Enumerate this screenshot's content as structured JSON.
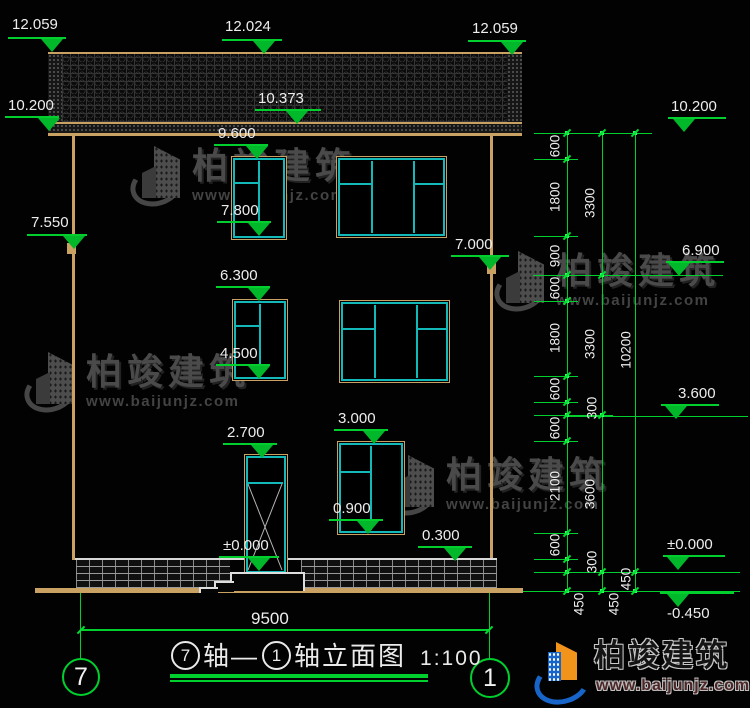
{
  "drawing": {
    "title": "⑦轴—①轴立面图 1:100",
    "title_block": {
      "axis_a": "7",
      "seg_a": "轴—",
      "axis_b": "1",
      "seg_b": "轴立面图",
      "scale": "1:100"
    },
    "axis_bubbles": {
      "left": "7",
      "right": "1"
    },
    "width_dim": "9500",
    "brand": {
      "name": "柏竣建筑",
      "url": "www.baijunjz.com"
    },
    "colors": {
      "line_green": "#00cf2e",
      "frame_tan": "#c9a263",
      "window_cyan": "#13b8b8",
      "text_white": "#ededed",
      "logo_blue": "#1765c8",
      "logo_orange": "#f2931c"
    },
    "elevation_markers": [
      {
        "label": "12.059",
        "tx": 12,
        "ty": 17,
        "bx": 8,
        "by": 37,
        "bw": 58,
        "ax": 52
      },
      {
        "label": "12.024",
        "tx": 225,
        "ty": 19,
        "bx": 222,
        "by": 39,
        "bw": 60,
        "ax": 264
      },
      {
        "label": "12.059",
        "tx": 472,
        "ty": 21,
        "bx": 468,
        "by": 40,
        "bw": 58,
        "ax": 512
      },
      {
        "label": "10.200",
        "tx": 8,
        "ty": 98,
        "bx": 5,
        "by": 116,
        "bw": 54,
        "ax": 49
      },
      {
        "label": "10.373",
        "tx": 258,
        "ty": 91,
        "bx": 255,
        "by": 109,
        "bw": 66,
        "ax": 297
      },
      {
        "label": "10.200",
        "tx": 671,
        "ty": 99,
        "bx": 668,
        "by": 117,
        "bw": 58,
        "ax": 684
      },
      {
        "label": "9.600",
        "tx": 218,
        "ty": 126,
        "bx": 214,
        "by": 144,
        "bw": 54,
        "ax": 257
      },
      {
        "label": "7.800",
        "tx": 221,
        "ty": 203,
        "bx": 217,
        "by": 221,
        "bw": 54,
        "ax": 259
      },
      {
        "label": "7.550",
        "tx": 31,
        "ty": 215,
        "bx": 27,
        "by": 234,
        "bw": 60,
        "ax": 74
      },
      {
        "label": "7.000",
        "tx": 455,
        "ty": 237,
        "bx": 451,
        "by": 255,
        "bw": 58,
        "ax": 490
      },
      {
        "label": "6.900",
        "tx": 682,
        "ty": 243,
        "bx": 666,
        "by": 261,
        "bw": 58,
        "ax": 679
      },
      {
        "label": "6.300",
        "tx": 220,
        "ty": 268,
        "bx": 216,
        "by": 286,
        "bw": 54,
        "ax": 259
      },
      {
        "label": "4.500",
        "tx": 220,
        "ty": 346,
        "bx": 216,
        "by": 364,
        "bw": 54,
        "ax": 259
      },
      {
        "label": "3.600",
        "tx": 678,
        "ty": 386,
        "bx": 661,
        "by": 404,
        "bw": 58,
        "ax": 676
      },
      {
        "label": "3.000",
        "tx": 338,
        "ty": 411,
        "bx": 334,
        "by": 429,
        "bw": 54,
        "ax": 374
      },
      {
        "label": "2.700",
        "tx": 227,
        "ty": 425,
        "bx": 223,
        "by": 443,
        "bw": 54,
        "ax": 262
      },
      {
        "label": "0.900",
        "tx": 333,
        "ty": 501,
        "bx": 329,
        "by": 519,
        "bw": 54,
        "ax": 368
      },
      {
        "label": "0.300",
        "tx": 422,
        "ty": 528,
        "bx": 418,
        "by": 546,
        "bw": 54,
        "ax": 455
      },
      {
        "label": "±0.000",
        "tx": 223,
        "ty": 538,
        "bx": 219,
        "by": 556,
        "bw": 60,
        "ax": 259
      },
      {
        "label": "±0.000",
        "tx": 667,
        "ty": 537,
        "bx": 663,
        "by": 555,
        "bw": 62,
        "ax": 678
      },
      {
        "label": "-0.450",
        "tx": 667,
        "ty": 606,
        "bx": 660,
        "by": 592,
        "bw": 74,
        "ax": 678
      }
    ],
    "dim_chains": {
      "lines": [
        {
          "x": 567,
          "y1": 133,
          "y2": 591
        },
        {
          "x": 602,
          "y1": 133,
          "y2": 591
        },
        {
          "x": 635,
          "y1": 133,
          "y2": 591
        }
      ],
      "ticks": [
        {
          "x": 567,
          "ys": [
            133,
            159,
            236,
            275,
            301,
            376,
            402,
            415,
            441,
            533,
            559,
            572,
            591
          ]
        },
        {
          "x": 602,
          "ys": [
            133,
            275,
            415,
            572,
            591
          ]
        },
        {
          "x": 635,
          "ys": [
            133,
            572,
            591
          ]
        }
      ]
    },
    "dimensions": [
      {
        "v": "600",
        "x": 555,
        "y": 146
      },
      {
        "v": "1800",
        "x": 555,
        "y": 197
      },
      {
        "v": "900",
        "x": 555,
        "y": 256
      },
      {
        "v": "600",
        "x": 555,
        "y": 288
      },
      {
        "v": "1800",
        "x": 555,
        "y": 338
      },
      {
        "v": "600",
        "x": 555,
        "y": 389
      },
      {
        "v": "300",
        "x": 592,
        "y": 408
      },
      {
        "v": "600",
        "x": 555,
        "y": 428
      },
      {
        "v": "2100",
        "x": 555,
        "y": 486
      },
      {
        "v": "600",
        "x": 555,
        "y": 545
      },
      {
        "v": "300",
        "x": 592,
        "y": 562
      },
      {
        "v": "450",
        "x": 579,
        "y": 604
      },
      {
        "v": "3300",
        "x": 590,
        "y": 203
      },
      {
        "v": "3300",
        "x": 590,
        "y": 344
      },
      {
        "v": "3600",
        "x": 590,
        "y": 494
      },
      {
        "v": "450",
        "x": 614,
        "y": 604
      },
      {
        "v": "10200",
        "x": 626,
        "y": 350
      },
      {
        "v": "450",
        "x": 626,
        "y": 579
      }
    ],
    "level_lines": [
      {
        "x1": 535,
        "x2": 652,
        "y": 133
      },
      {
        "x1": 533,
        "x2": 723,
        "y": 275
      },
      {
        "x1": 567,
        "x2": 748,
        "y": 416
      },
      {
        "x1": 567,
        "x2": 740,
        "y": 572
      },
      {
        "x1": 523,
        "x2": 740,
        "y": 591
      }
    ],
    "windows": [
      {
        "x": 232,
        "y": 157,
        "w": 52,
        "h": 80,
        "kind": "small"
      },
      {
        "x": 337,
        "y": 157,
        "w": 107,
        "h": 78,
        "kind": "large"
      },
      {
        "x": 233,
        "y": 300,
        "w": 52,
        "h": 78,
        "kind": "small"
      },
      {
        "x": 340,
        "y": 301,
        "w": 107,
        "h": 79,
        "kind": "large"
      },
      {
        "x": 338,
        "y": 442,
        "w": 64,
        "h": 90,
        "kind": "small"
      }
    ],
    "watermark_positions": [
      {
        "x": 130,
        "y": 144
      },
      {
        "x": 24,
        "y": 350
      },
      {
        "x": 494,
        "y": 249
      },
      {
        "x": 384,
        "y": 453
      }
    ]
  }
}
